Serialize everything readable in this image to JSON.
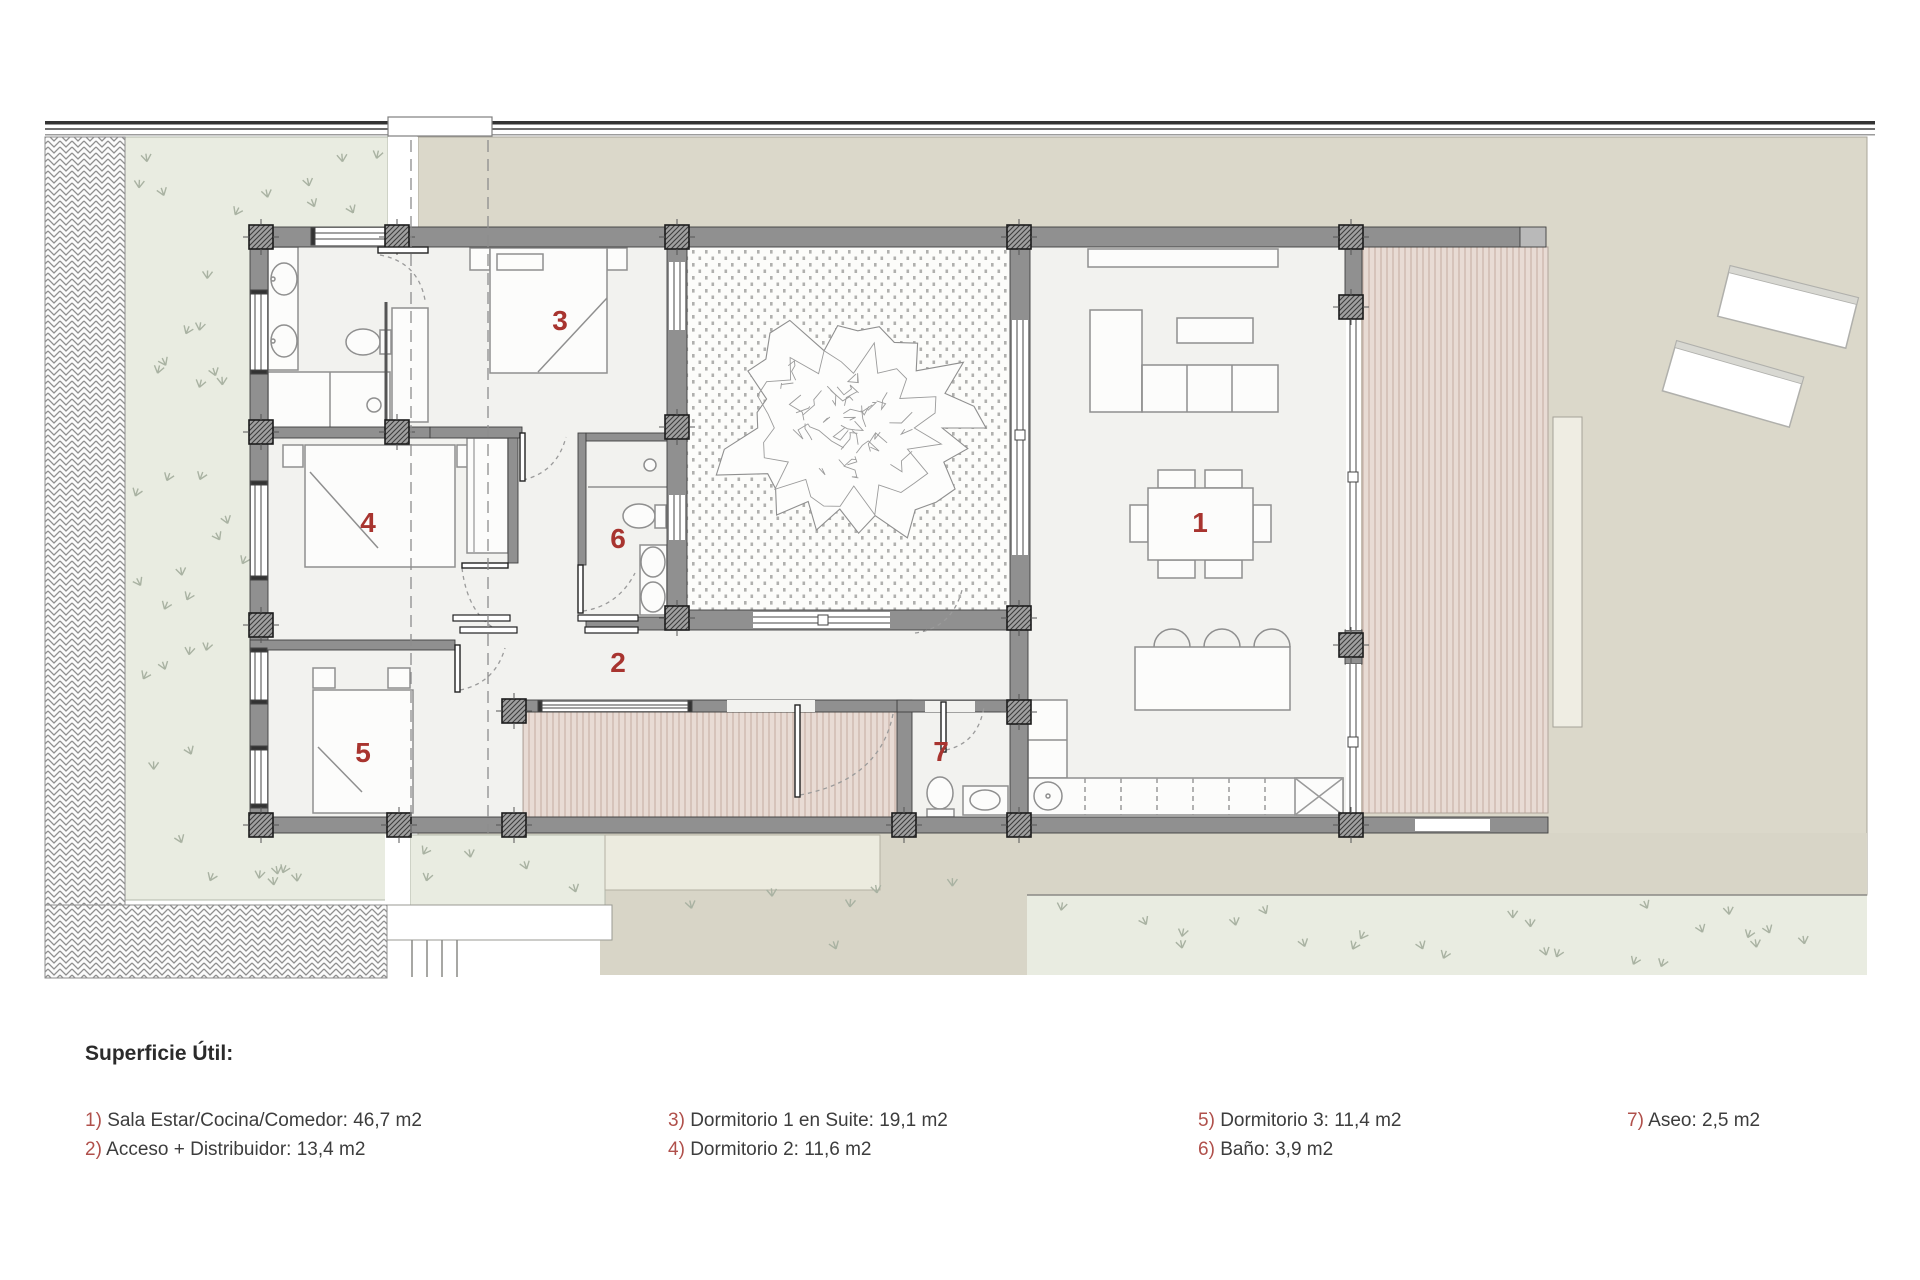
{
  "legend": {
    "title": "Superficie Útil:",
    "items": [
      {
        "num": "1)",
        "text": "Sala Estar/Cocina/Comedor: 46,7 m2"
      },
      {
        "num": "2)",
        "text": "Acceso + Distribuidor: 13,4 m2"
      },
      {
        "num": "3)",
        "text": "Dormitorio 1 en Suite: 19,1 m2"
      },
      {
        "num": "4)",
        "text": "Dormitorio 2: 11,6 m2"
      },
      {
        "num": "5)",
        "text": "Dormitorio 3: 11,4 m2"
      },
      {
        "num": "6)",
        "text": "Baño: 3,9 m2"
      },
      {
        "num": "7)",
        "text": "Aseo: 2,5 m2"
      }
    ]
  },
  "rooms": [
    {
      "number": "1",
      "name": "Sala Estar/Cocina/Comedor",
      "area": "46,7 m2"
    },
    {
      "number": "2",
      "name": "Acceso + Distribuidor",
      "area": "13,4 m2"
    },
    {
      "number": "3",
      "name": "Dormitorio 1 en Suite",
      "area": "19,1 m2"
    },
    {
      "number": "4",
      "name": "Dormitorio 2",
      "area": "11,6 m2"
    },
    {
      "number": "5",
      "name": "Dormitorio 3",
      "area": "11,4 m2"
    },
    {
      "number": "6",
      "name": "Baño",
      "area": "3,9 m2"
    },
    {
      "number": "7",
      "name": "Aseo",
      "area": "2,5 m2"
    }
  ],
  "colors": {
    "room_label_red": "#a8342f",
    "legend_red": "#b0504b",
    "wall_gray": "#909090",
    "terrain_beige": "#dbd8ca",
    "grass_green": "#e9ece1",
    "deck_wood": "#e8dbd4",
    "floor": "#f2f2ef"
  }
}
